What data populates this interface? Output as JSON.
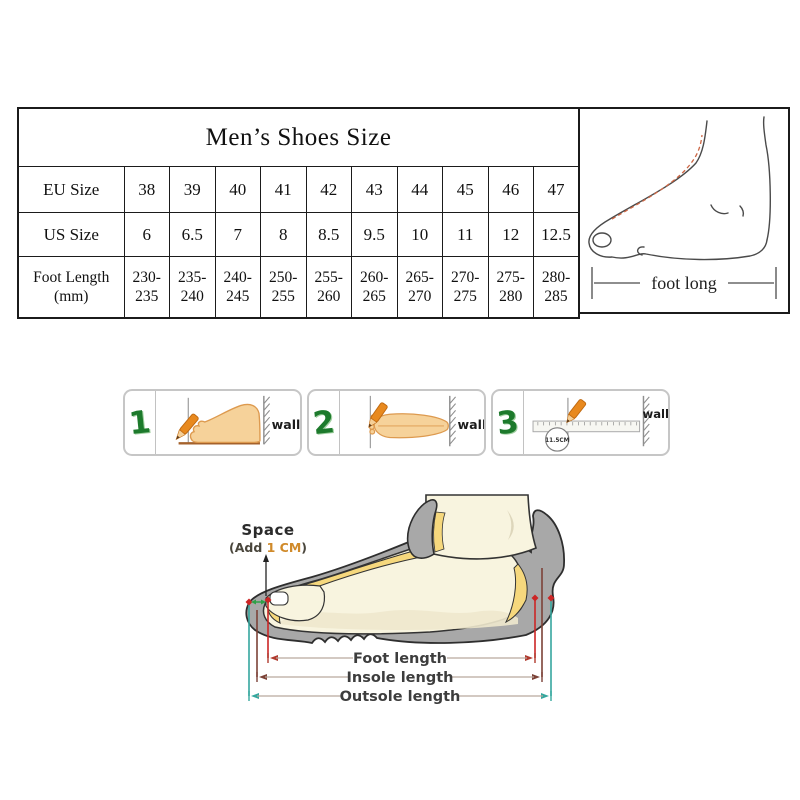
{
  "size_table": {
    "title": "Men’s Shoes Size",
    "eu_row": {
      "label": "EU Size",
      "values": [
        "38",
        "39",
        "40",
        "41",
        "42",
        "43",
        "44",
        "45",
        "46",
        "47"
      ]
    },
    "us_row": {
      "label": "US Size",
      "values": [
        "6",
        "6.5",
        "7",
        "8",
        "8.5",
        "9.5",
        "10",
        "11",
        "12",
        "12.5"
      ]
    },
    "foot_row": {
      "label": "Foot Length",
      "label_unit": "(mm)",
      "values": [
        "230-235",
        "235-240",
        "240-245",
        "250-255",
        "255-260",
        "260-265",
        "265-270",
        "270-275",
        "275-280",
        "280-285"
      ]
    }
  },
  "foot_measure_panel": {
    "caption": "foot long"
  },
  "how_to_measure_steps": [
    {
      "number": "1",
      "wall_label": "wall"
    },
    {
      "number": "2",
      "wall_label": "wall"
    },
    {
      "number": "3",
      "wall_label": "wall",
      "ruler_mark": "11.5CM"
    }
  ],
  "shoe_length_diagram": {
    "space_label": "Space",
    "space_note_prefix": "(Add ",
    "space_note_value": "1 CM",
    "space_note_suffix": ")",
    "foot_length_label": "Foot length",
    "insole_length_label": "Insole length",
    "outsole_length_label": "Outsole length"
  },
  "colors": {
    "accent_green": "#1d7a2c",
    "skin": "#f6d29a",
    "pencil_orange": "#e8891e",
    "sole_gray": "#a8a8a8",
    "insole_yellow": "#f6d87d",
    "foot_cream": "#f8f4df",
    "measure_red": "#b03a2e",
    "measure_teal": "#35a79e",
    "measure_maroon": "#7c4237",
    "space_value_orange": "#d08a2a"
  }
}
